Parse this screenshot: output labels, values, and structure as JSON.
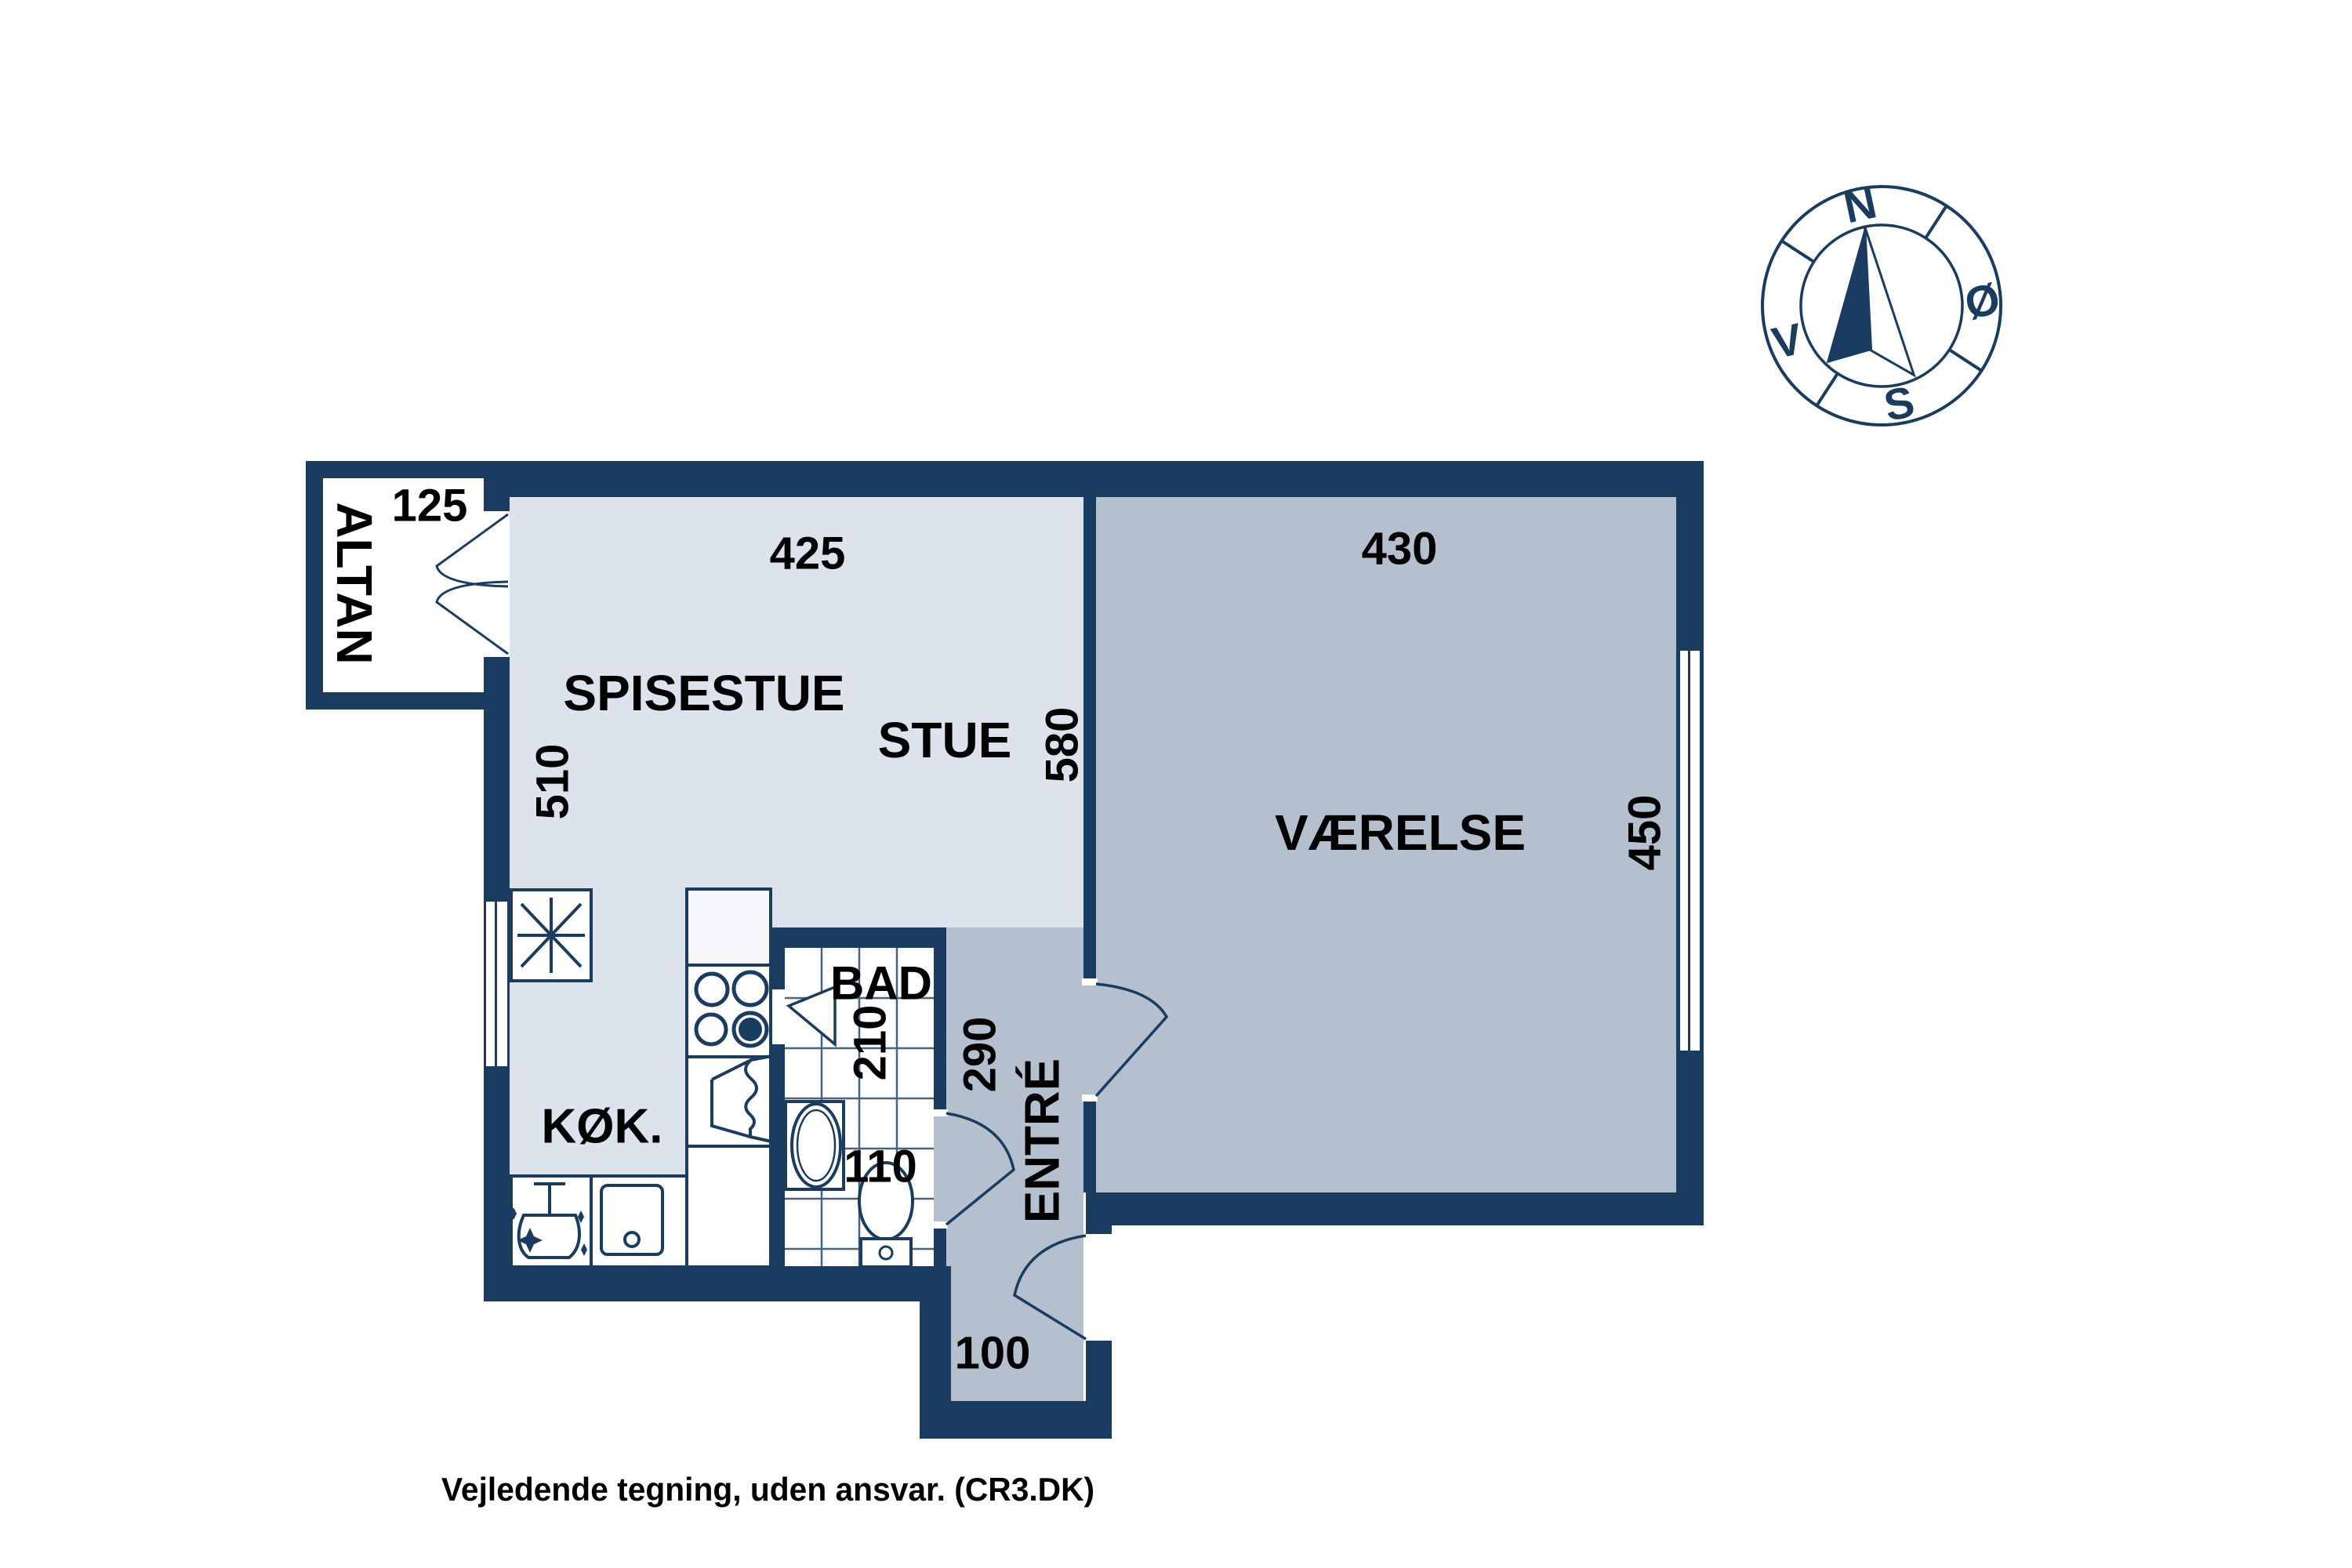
{
  "floorplan": {
    "balcony": {
      "label": "ALTAN",
      "dim_width": "125"
    },
    "dining": {
      "label": "SPISESTUE",
      "dim_top": "425",
      "dim_left": "510"
    },
    "living": {
      "label": "STUE",
      "dim_right": "580"
    },
    "bedroom": {
      "label": "VÆRELSE",
      "dim_top": "430",
      "dim_right": "450"
    },
    "kitchen": {
      "label": "KØK."
    },
    "bath": {
      "label": "BAD",
      "dim_upper": "210",
      "dim_lower": "110"
    },
    "entry": {
      "label": "ENTRÉ",
      "dim": "290",
      "hall_dim": "100"
    }
  },
  "compass": {
    "north": "N",
    "east": "Ø",
    "south": "S",
    "west": "V"
  },
  "footer": {
    "disclaimer": "Vejledende tegning, uden ansvar. (CR3.DK)"
  },
  "colors": {
    "wall": "#1b3c61",
    "floor_light": "#dde3ec",
    "floor_dark": "#b4c0cd",
    "text": "#000000"
  }
}
